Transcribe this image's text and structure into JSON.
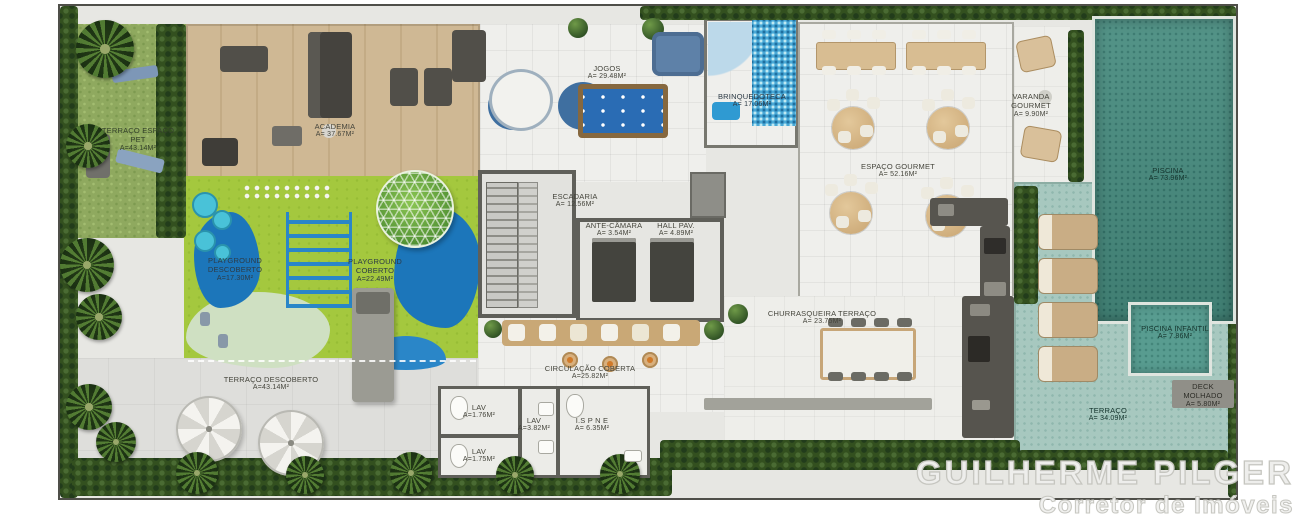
{
  "watermark": {
    "name": "GUILHERME PILGER",
    "role": "Corretor de Imóveis"
  },
  "rooms": {
    "terraco_espaco_pet": {
      "label": "TERRAÇO ESPAÇO PET",
      "area": "A=43.14m²"
    },
    "academia": {
      "label": "ACADEMIA",
      "area": "A= 37.67m²"
    },
    "jogos": {
      "label": "JOGOS",
      "area": "A= 29.48m²"
    },
    "brinquedoteca": {
      "label": "BRINQUEDOTECA",
      "area": "A= 17.06m²"
    },
    "varanda_gourmet": {
      "label": "VARANDA GOURMET",
      "area": "A= 9.90m²"
    },
    "espaco_gourmet": {
      "label": "ESPAÇO GOURMET",
      "area": "A= 52.16m²"
    },
    "piscina": {
      "label": "PISCINA",
      "area": "A= 73.96m²"
    },
    "escadaria": {
      "label": "ESCADARIA",
      "area": "A= 12.56m²"
    },
    "ante_camara": {
      "label": "ANTE-CÂMARA",
      "area": "A= 3.54m²"
    },
    "hall_pav": {
      "label": "HALL PAV.",
      "area": "A= 4.89m²"
    },
    "playground_descoberto": {
      "label": "PLAYGROUND DESCOBERTO",
      "area": "A=17.30m²"
    },
    "playground_coberto": {
      "label": "PLAYGROUND COBERTO",
      "area": "A=22.49m²"
    },
    "churrasqueira_terraco": {
      "label": "CHURRASQUEIRA TERRAÇO",
      "area": "A= 23.75m²"
    },
    "piscina_infantil": {
      "label": "PISCINA INFANTIL",
      "area": "A= 7.86m²"
    },
    "terraco_descoberto": {
      "label": "TERRAÇO DESCOBERTO",
      "area": "A=43.14m²"
    },
    "circulacao_coberta": {
      "label": "CIRCULAÇÃO COBERTA",
      "area": "A=25.82m²"
    },
    "lav_1": {
      "label": "LAV",
      "area": "A=1.76m²"
    },
    "lav_2": {
      "label": "LAV",
      "area": "A=3.82m²"
    },
    "lav_3": {
      "label": "LAV",
      "area": "A=1.75m²"
    },
    "is_pne": {
      "label": "I.S P N E",
      "area": "A= 6.35m²"
    },
    "deck_molhado": {
      "label": "DECK MOLHADO",
      "area": "A= 5.80m²"
    },
    "terraco": {
      "label": "TERRAÇO",
      "area": "A= 34.09m²"
    }
  },
  "colors": {
    "lawn": "#8fa95f",
    "wood": "#cbb592",
    "pool_water": "#478c7f",
    "deck": "#a7c8bf",
    "playground_green": "#a4c83e",
    "playground_blue": "#1c76ba",
    "hedge": "#33501f",
    "wall": "#5f5f59",
    "floor": "#ecece8",
    "watermark_gray": "#c6c6c0"
  }
}
